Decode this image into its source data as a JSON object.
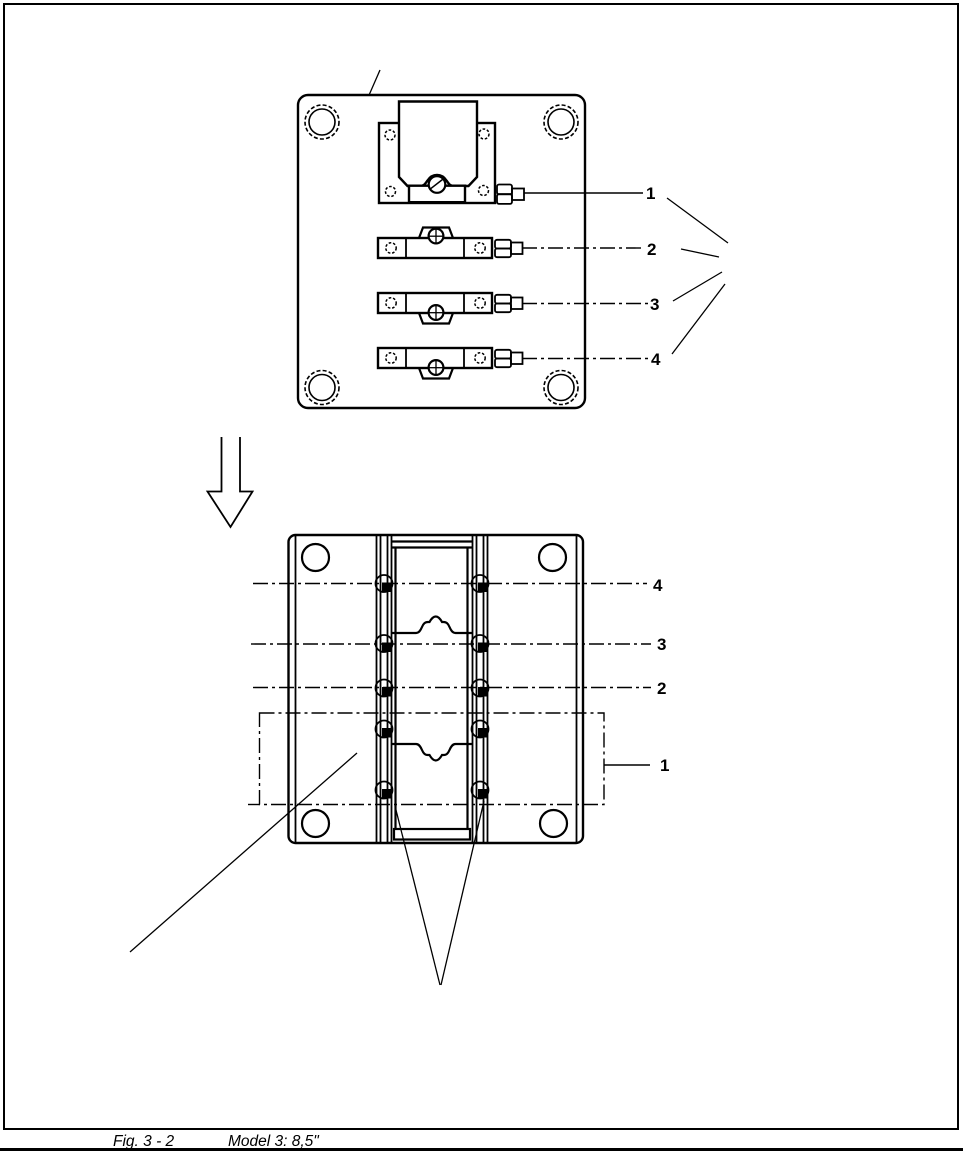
{
  "figure": {
    "caption": {
      "figure_label": "Fig. 3 - 2",
      "model_label": "Model 3:  8,5\""
    },
    "top_view": {
      "description": "plan view of mounting plate with clamp bracket and three clamp bars",
      "callouts": [
        "1",
        "2",
        "3",
        "4"
      ]
    },
    "bottom_view": {
      "description": "assembled plan view with center lines and zone box",
      "callouts": [
        "4",
        "3",
        "2",
        "1"
      ]
    },
    "colors": {
      "line": "#000000",
      "background": "#ffffff"
    }
  }
}
